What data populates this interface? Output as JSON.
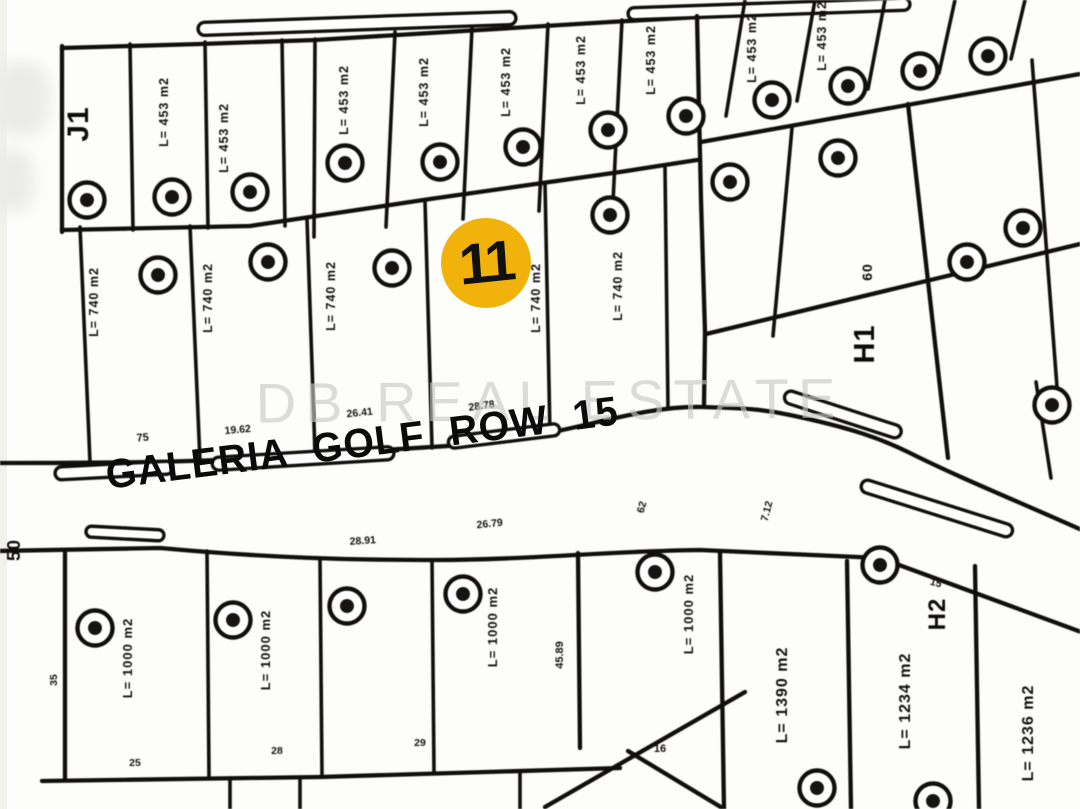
{
  "canvas": {
    "width": 1080,
    "height": 809,
    "paper": "#fdfdfc",
    "ink": "#151412"
  },
  "watermark": {
    "text": "DB REAL ESTATE",
    "color": "#c7c7c7"
  },
  "road": {
    "label": "GALERIA GOLF ROW 15",
    "angle_deg": -7.2
  },
  "marker": {
    "label": "11",
    "color": "#F1B20B",
    "text_color": "#111111",
    "x": 486,
    "y": 263,
    "r": 45
  },
  "districts": [
    {
      "text": "J1",
      "x": 88,
      "y": 124,
      "size": 30,
      "rot": -90
    },
    {
      "text": "H1",
      "x": 874,
      "y": 344,
      "size": 29,
      "rot": -90
    },
    {
      "text": "H2",
      "x": 945,
      "y": 614,
      "size": 24,
      "rot": -90
    },
    {
      "text": "50",
      "x": 20,
      "y": 550,
      "size": 18,
      "rot": -90
    },
    {
      "text": "60",
      "x": 872,
      "y": 272,
      "size": 14,
      "rot": -90
    }
  ],
  "lot_markers": [
    {
      "x": 87,
      "y": 200
    },
    {
      "x": 172,
      "y": 197
    },
    {
      "x": 250,
      "y": 192
    },
    {
      "x": 345,
      "y": 163
    },
    {
      "x": 440,
      "y": 162
    },
    {
      "x": 523,
      "y": 147
    },
    {
      "x": 608,
      "y": 130
    },
    {
      "x": 686,
      "y": 116
    },
    {
      "x": 772,
      "y": 100
    },
    {
      "x": 848,
      "y": 86
    },
    {
      "x": 920,
      "y": 71
    },
    {
      "x": 988,
      "y": 56
    },
    {
      "x": 730,
      "y": 182
    },
    {
      "x": 838,
      "y": 158
    },
    {
      "x": 967,
      "y": 262
    },
    {
      "x": 1023,
      "y": 228
    },
    {
      "x": 1052,
      "y": 405
    },
    {
      "x": 158,
      "y": 275
    },
    {
      "x": 268,
      "y": 262
    },
    {
      "x": 392,
      "y": 268
    },
    {
      "x": 610,
      "y": 215
    },
    {
      "x": 95,
      "y": 628
    },
    {
      "x": 233,
      "y": 620
    },
    {
      "x": 347,
      "y": 606
    },
    {
      "x": 463,
      "y": 594
    },
    {
      "x": 655,
      "y": 572
    },
    {
      "x": 880,
      "y": 565
    },
    {
      "x": 817,
      "y": 788
    },
    {
      "x": 933,
      "y": 801
    }
  ],
  "area_labels": [
    {
      "text": "L= 453 m2",
      "x": 168,
      "y": 112,
      "size": 12.5
    },
    {
      "text": "L= 453 m2",
      "x": 228,
      "y": 138,
      "size": 12.5
    },
    {
      "text": "L= 453 m2",
      "x": 348,
      "y": 100,
      "size": 12.5
    },
    {
      "text": "L= 453 m2",
      "x": 428,
      "y": 92,
      "size": 12.5
    },
    {
      "text": "L= 453 m2",
      "x": 510,
      "y": 82,
      "size": 12.5
    },
    {
      "text": "L= 453 m2",
      "x": 585,
      "y": 70,
      "size": 12.5
    },
    {
      "text": "L= 453 m2",
      "x": 655,
      "y": 60,
      "size": 12.5
    },
    {
      "text": "L= 453 m2",
      "x": 756,
      "y": 48,
      "size": 12.5
    },
    {
      "text": "L= 453 m2",
      "x": 826,
      "y": 36,
      "size": 12.5
    },
    {
      "text": "L= 740 m2",
      "x": 98,
      "y": 302,
      "size": 12.5
    },
    {
      "text": "L= 740 m2",
      "x": 212,
      "y": 298,
      "size": 12.5
    },
    {
      "text": "L= 740 m2",
      "x": 335,
      "y": 296,
      "size": 12.5
    },
    {
      "text": "L= 740 m2",
      "x": 540,
      "y": 298,
      "size": 12.5
    },
    {
      "text": "L= 740 m2",
      "x": 622,
      "y": 286,
      "size": 12.5
    },
    {
      "text": "L= 1000 m2",
      "x": 132,
      "y": 658,
      "size": 13
    },
    {
      "text": "L= 1000 m2",
      "x": 270,
      "y": 650,
      "size": 13
    },
    {
      "text": "L= 1000 m2",
      "x": 497,
      "y": 627,
      "size": 13
    },
    {
      "text": "L= 1000 m2",
      "x": 693,
      "y": 614,
      "size": 13
    },
    {
      "text": "L= 1390 m2",
      "x": 787,
      "y": 695,
      "size": 16
    },
    {
      "text": "L= 1234 m2",
      "x": 910,
      "y": 701,
      "size": 16
    },
    {
      "text": "L= 1236 m2",
      "x": 1033,
      "y": 733,
      "size": 16
    }
  ],
  "dimensions": [
    {
      "text": "75",
      "x": 143,
      "y": 441,
      "rot": -5,
      "size": 11
    },
    {
      "text": "19.62",
      "x": 238,
      "y": 433,
      "rot": -5,
      "size": 10.5
    },
    {
      "text": "26.41",
      "x": 360,
      "y": 416,
      "rot": -6,
      "size": 10.5
    },
    {
      "text": "28.78",
      "x": 482,
      "y": 409,
      "rot": -8,
      "size": 10.5
    },
    {
      "text": "28.91",
      "x": 363,
      "y": 544,
      "rot": -4,
      "size": 10.5
    },
    {
      "text": "26.79",
      "x": 490,
      "y": 527,
      "rot": -6,
      "size": 10.5
    },
    {
      "text": "62",
      "x": 645,
      "y": 508,
      "rot": -75,
      "size": 10.5
    },
    {
      "text": "7.12",
      "x": 770,
      "y": 512,
      "rot": -75,
      "size": 10.5
    },
    {
      "text": "45.89",
      "x": 563,
      "y": 655,
      "rot": -90,
      "size": 11
    },
    {
      "text": "35",
      "x": 57,
      "y": 680,
      "rot": -90,
      "size": 10.5
    },
    {
      "text": "15",
      "x": 935,
      "y": 586,
      "rot": 15,
      "size": 10.5
    },
    {
      "text": "16",
      "x": 660,
      "y": 752,
      "rot": 0,
      "size": 11
    },
    {
      "text": "25",
      "x": 135,
      "y": 766,
      "rot": 0,
      "size": 10.5
    },
    {
      "text": "28",
      "x": 277,
      "y": 754,
      "rot": 0,
      "size": 10.5
    },
    {
      "text": "29",
      "x": 420,
      "y": 746,
      "rot": 0,
      "size": 10.5
    }
  ]
}
